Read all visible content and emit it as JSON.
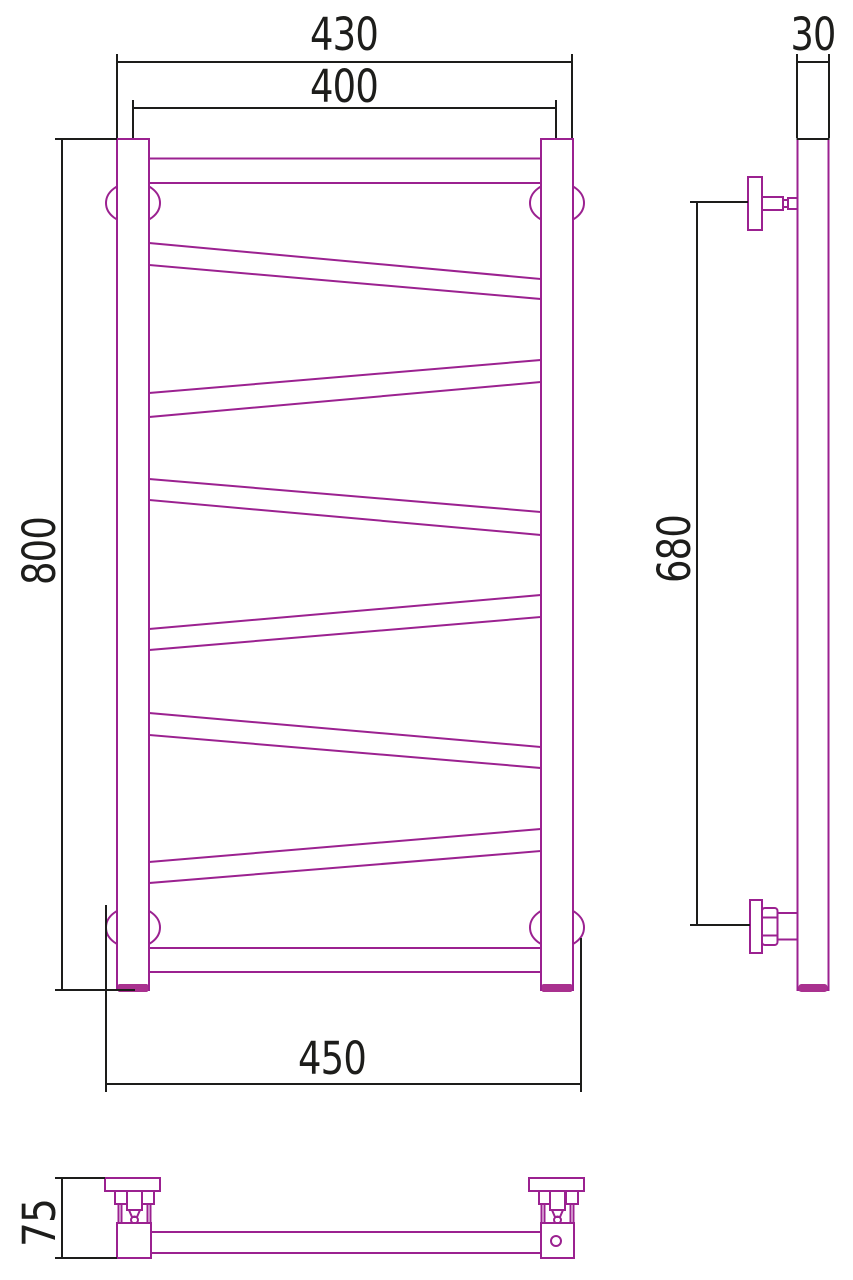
{
  "drawing": {
    "kind": "technical dimension drawing",
    "subject": "wall-mounted ladder towel rail with zigzag crossbars",
    "units": "mm",
    "colors": {
      "product_outline": "#9B2190",
      "product_accent_fill": "#A9318F",
      "dimension_lines": "#1D1D1B",
      "background": "#FFFFFF"
    },
    "views": {
      "front": {
        "name": "front view",
        "crossbars_horizontal": 2,
        "crossbars_diagonal": 6,
        "dimensions": {
          "overall_width": "430",
          "axis_width": "400",
          "overall_height": "800",
          "flange_span_width": "450"
        }
      },
      "side": {
        "name": "side view",
        "dimensions": {
          "profile_depth": "30",
          "bracket_spacing_height": "680"
        }
      },
      "top": {
        "name": "top view",
        "dimensions": {
          "wall_offset_depth": "75"
        }
      }
    }
  }
}
